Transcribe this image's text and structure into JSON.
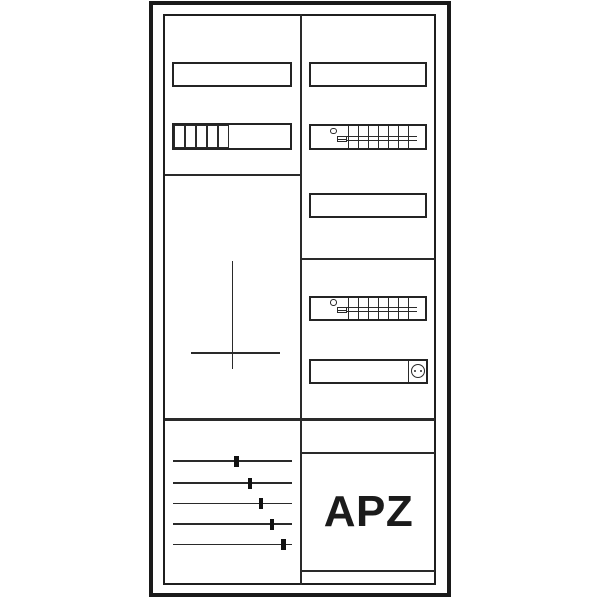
{
  "meta": {
    "background_color": "#ffffff",
    "line_color": "#2a2a2a",
    "frame_color": "#1a1a1a"
  },
  "cabinet": {
    "type": "meter-cabinet-line-drawing",
    "left_column": {
      "cover_plate_top": "blank-rectangle",
      "module_strip": {
        "cell_count": 5
      },
      "meter_field": {
        "symbol": "mounting-cross"
      },
      "distribution": {
        "circuit_count": 5,
        "circuits": [
          {
            "line_y": 461,
            "breaker_x": 236.5
          },
          {
            "line_y": 483,
            "breaker_x": 250
          },
          {
            "line_y": 503.5,
            "breaker_x": 261
          },
          {
            "line_y": 524,
            "breaker_x": 272
          },
          {
            "line_y": 544.5,
            "breaker_x": 283.5
          }
        ]
      }
    },
    "right_column": {
      "cover_plate_top": "blank-rectangle",
      "cover_plate_mid": "blank-rectangle",
      "terminal_block": {
        "comb_teeth": 7,
        "tooth_spacing": 10,
        "tooth_start_x": 37
      },
      "socket": {
        "pin_count": 2
      },
      "apz_label": "APZ"
    }
  }
}
